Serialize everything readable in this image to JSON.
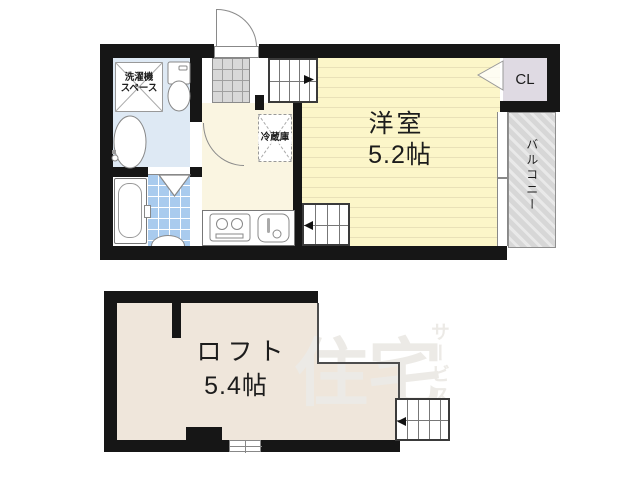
{
  "plan": {
    "upper_floor": {
      "main_room": {
        "label": "洋室",
        "size": "5.2帖"
      },
      "closet_label": "CL",
      "balcony_label": "バルコニー",
      "washer_space": {
        "line1": "洗濯機",
        "line2": "スペース"
      },
      "fridge_label": "冷蔵庫"
    },
    "loft_floor": {
      "label": "ロフト",
      "size": "5.4帖"
    },
    "watermark": {
      "text_main": "住宅",
      "text_sub": "サービス"
    },
    "colors": {
      "wall": "#161616",
      "washroom_floor": "#DEE9F4",
      "bath_tile": "#A9CBEE",
      "kitchen_floor": "#FAF5E1",
      "main_room_floor": "#FCF6C9",
      "main_room_stripe": "#E9E1B8",
      "entrance_tile": "#D8D8D8",
      "closet_fill": "#DFDAE3",
      "balcony_hatch": "#D7D7D7",
      "loft_floor": "#EFE6DB",
      "watermark": "#ECEAE6"
    }
  }
}
